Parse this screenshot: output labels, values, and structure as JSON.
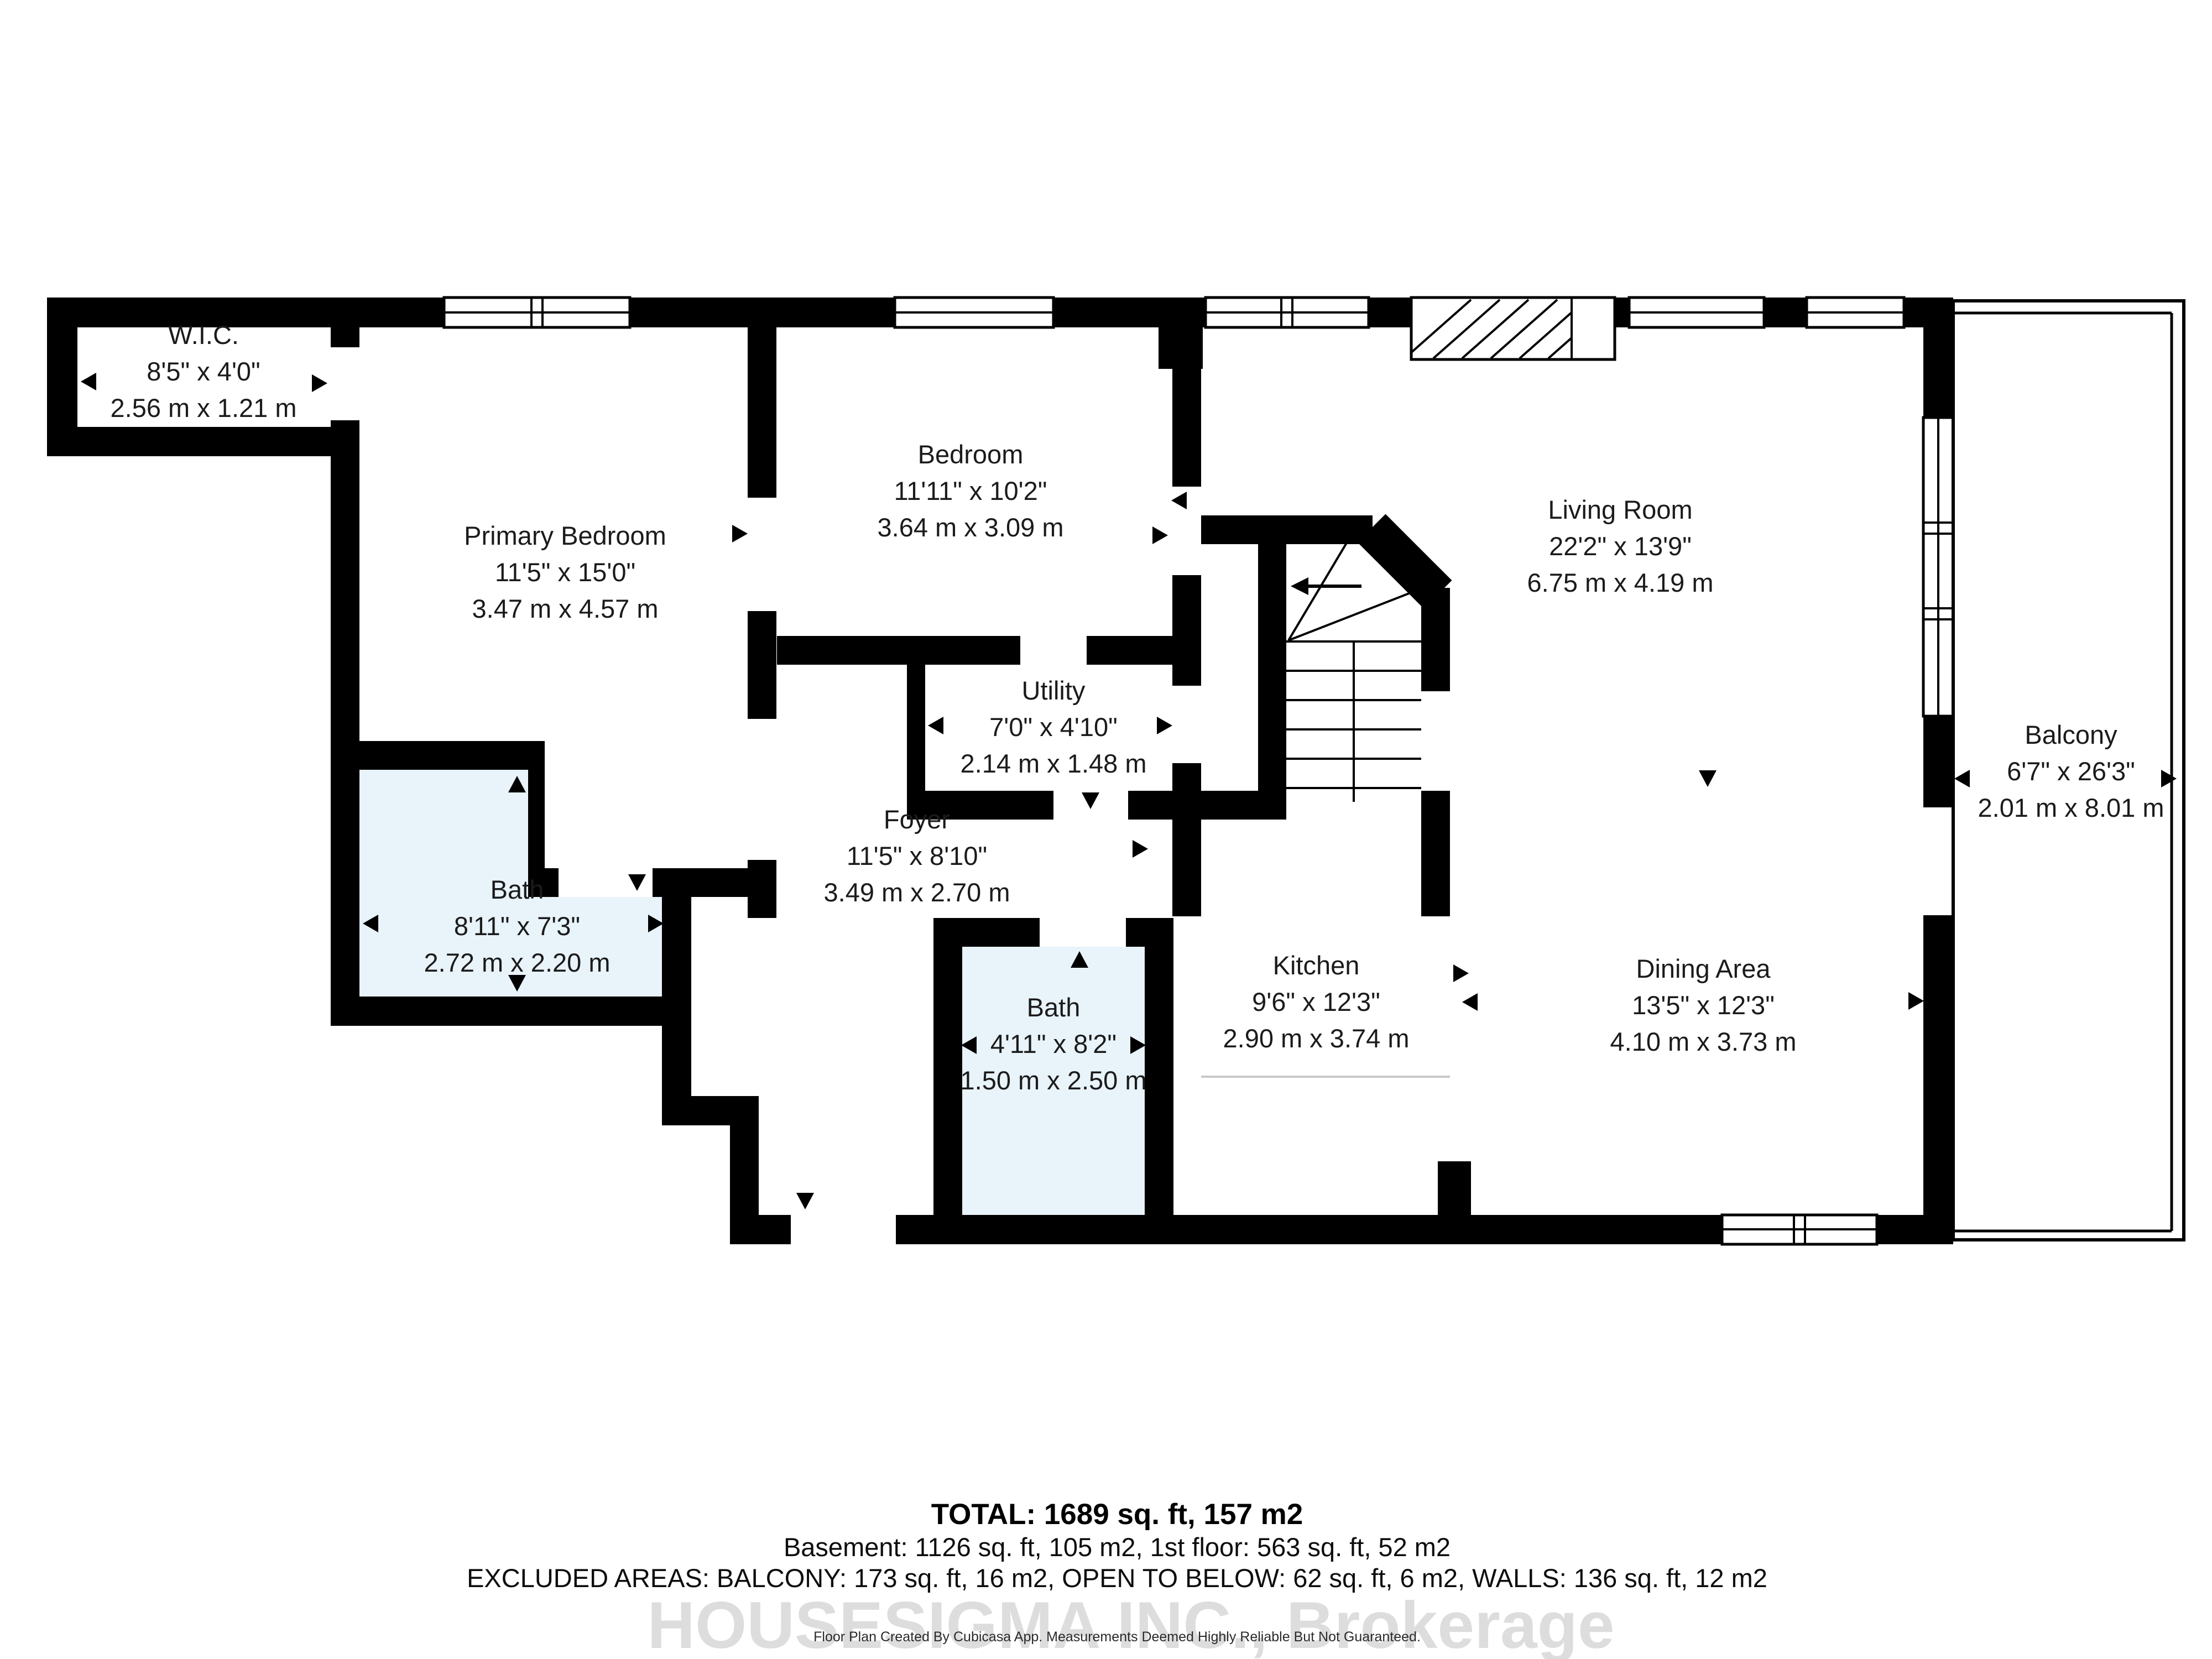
{
  "plan": {
    "rooms": [
      {
        "id": "wic",
        "name": "W.I.C.",
        "dims_imperial": "8'5\" x 4'0\"",
        "dims_metric": "2.56 m x 1.21 m"
      },
      {
        "id": "primary-bedroom",
        "name": "Primary Bedroom",
        "dims_imperial": "11'5\" x 15'0\"",
        "dims_metric": "3.47 m x 4.57 m"
      },
      {
        "id": "bedroom",
        "name": "Bedroom",
        "dims_imperial": "11'11\" x 10'2\"",
        "dims_metric": "3.64 m x 3.09 m"
      },
      {
        "id": "living-room",
        "name": "Living Room",
        "dims_imperial": "22'2\" x 13'9\"",
        "dims_metric": "6.75 m x 4.19 m"
      },
      {
        "id": "utility",
        "name": "Utility",
        "dims_imperial": "7'0\" x 4'10\"",
        "dims_metric": "2.14 m x 1.48 m"
      },
      {
        "id": "foyer",
        "name": "Foyer",
        "dims_imperial": "11'5\" x 8'10\"",
        "dims_metric": "3.49 m x 2.70 m"
      },
      {
        "id": "bath-main",
        "name": "Bath",
        "dims_imperial": "8'11\" x 7'3\"",
        "dims_metric": "2.72 m x 2.20 m"
      },
      {
        "id": "bath-small",
        "name": "Bath",
        "dims_imperial": "4'11\" x 8'2\"",
        "dims_metric": "1.50 m x 2.50 m"
      },
      {
        "id": "kitchen",
        "name": "Kitchen",
        "dims_imperial": "9'6\" x 12'3\"",
        "dims_metric": "2.90 m x 3.74 m"
      },
      {
        "id": "dining-area",
        "name": "Dining Area",
        "dims_imperial": "13'5\" x 12'3\"",
        "dims_metric": "4.10 m x 3.73 m"
      },
      {
        "id": "balcony",
        "name": "Balcony",
        "dims_imperial": "6'7\" x 26'3\"",
        "dims_metric": "2.01 m x 8.01 m"
      }
    ],
    "summary": {
      "total": "TOTAL: 1689 sq. ft, 157 m2",
      "floors": "Basement: 1126 sq. ft, 105 m2, 1st floor: 563 sq. ft, 52 m2",
      "excluded": "EXCLUDED AREAS: BALCONY: 173 sq. ft, 16 m2, OPEN TO BELOW: 62 sq. ft, 6 m2, WALLS: 136 sq. ft, 12 m2"
    },
    "watermark": "HOUSESIGMA INC., Brokerage",
    "credit": "Floor Plan Created By Cubicasa App. Measurements Deemed Highly Reliable But Not Guaranteed.",
    "colors": {
      "walls": "#000000",
      "bath_fill": "#e8f3fa",
      "floor": "#ffffff",
      "watermark": "#d8d8d8",
      "transition_line": "#c9c9c9"
    }
  }
}
